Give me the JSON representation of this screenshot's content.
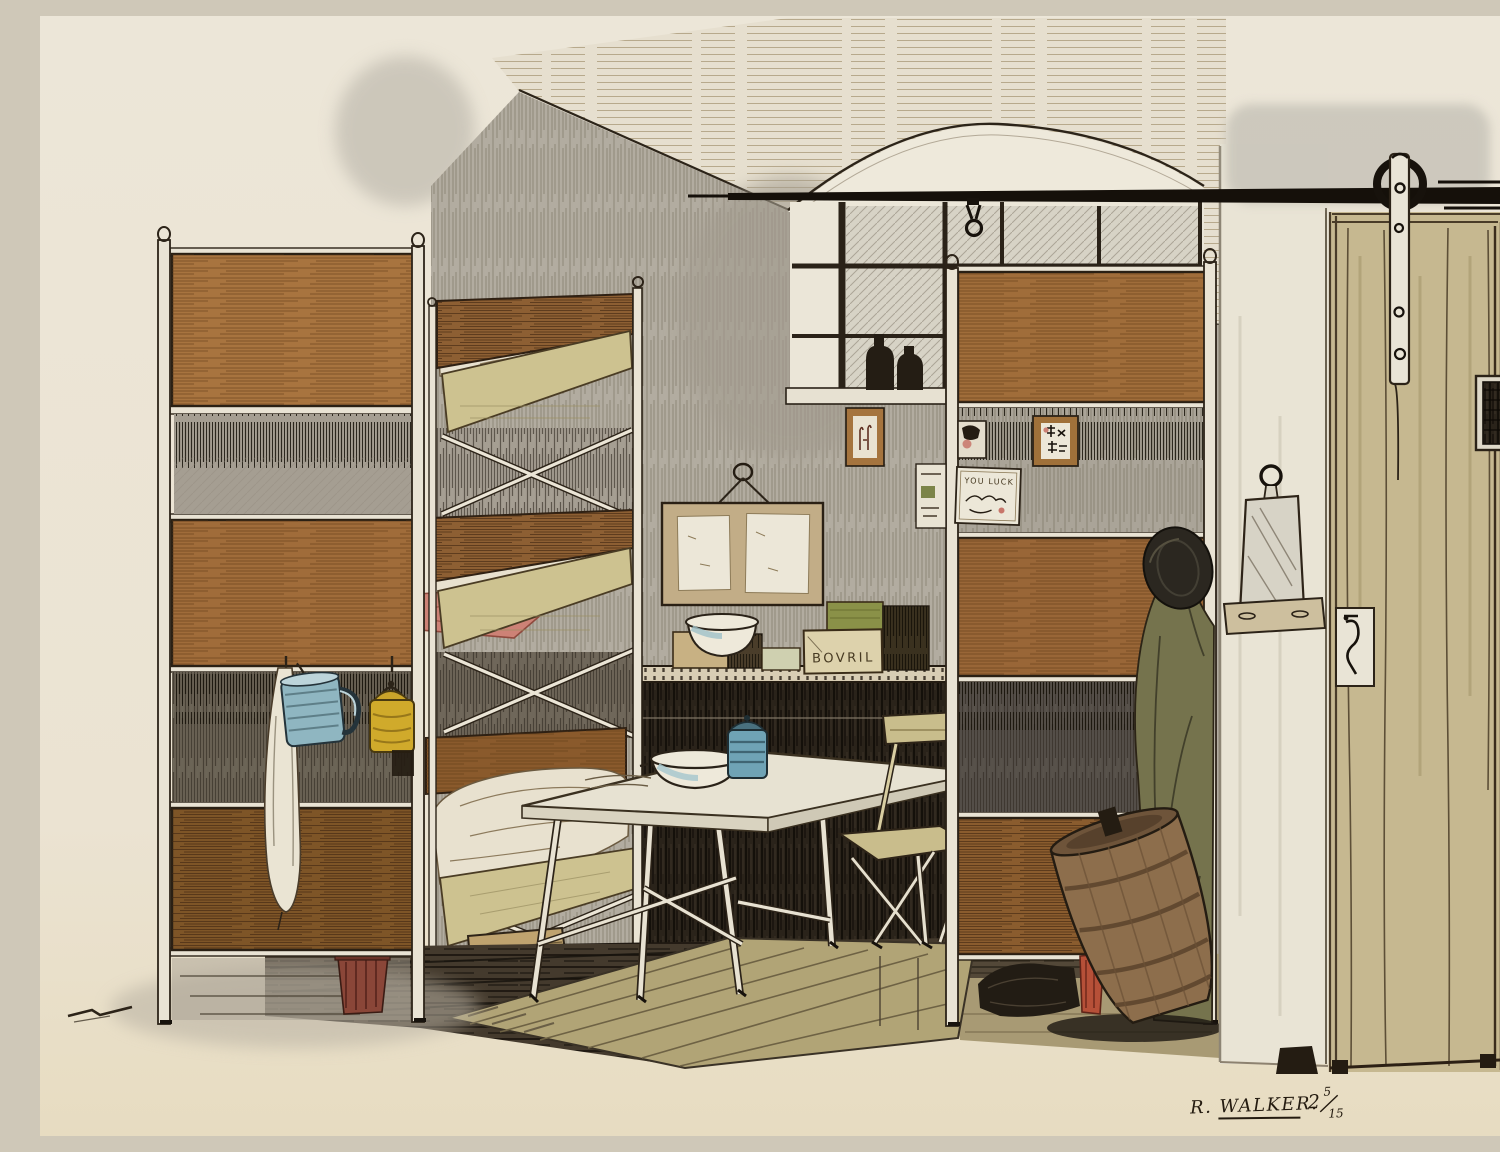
{
  "artwork": {
    "description": "Pen-and-ink and watercolour sketch of a hut interior: triple bunk beds behind wooden partition screens, a folding table with an enamel bowl and blue jar, a folding chair, a shelf of boxes, a notice board, a window with bottles, and a sliding plank door on a black rail.",
    "labels": {
      "bovril_box": "BOVRIL",
      "luck_card": "YOU LUCK"
    },
    "signature": {
      "name": "R. WALKER.",
      "number": "2",
      "frac_num": "5",
      "frac_den": "15"
    },
    "objects": [
      "triple bunk bed",
      "left partition screen",
      "right partition screen",
      "folding table",
      "folding chair",
      "enamel bowl",
      "blue lidded jar",
      "notice board with two papers",
      "shelf with boxes",
      "Bovril box",
      "window with two dark bottles",
      "sliding plank door",
      "door roller on rail",
      "hanging hook and ring",
      "mirror on bracket shelf",
      "coat and hat on hook",
      "leaning wooden tub",
      "blue enamel mug",
      "yellow canister",
      "white towel",
      "duckboard floor mat",
      "clay pot",
      "dark kitbag and boots",
      "red tin"
    ],
    "colors": {
      "paper": "#ece5d6",
      "wall": "#b2aca0",
      "wood_panel": "#a4713d",
      "door": "#c6b890",
      "floor_mat": "#b1a476",
      "blanket_pink": "#cd8276",
      "mug_blue": "#8fb6c1",
      "canister_yellow": "#d0aa2b",
      "coat_olive": "#75734d",
      "ink": "#2c2419"
    }
  }
}
